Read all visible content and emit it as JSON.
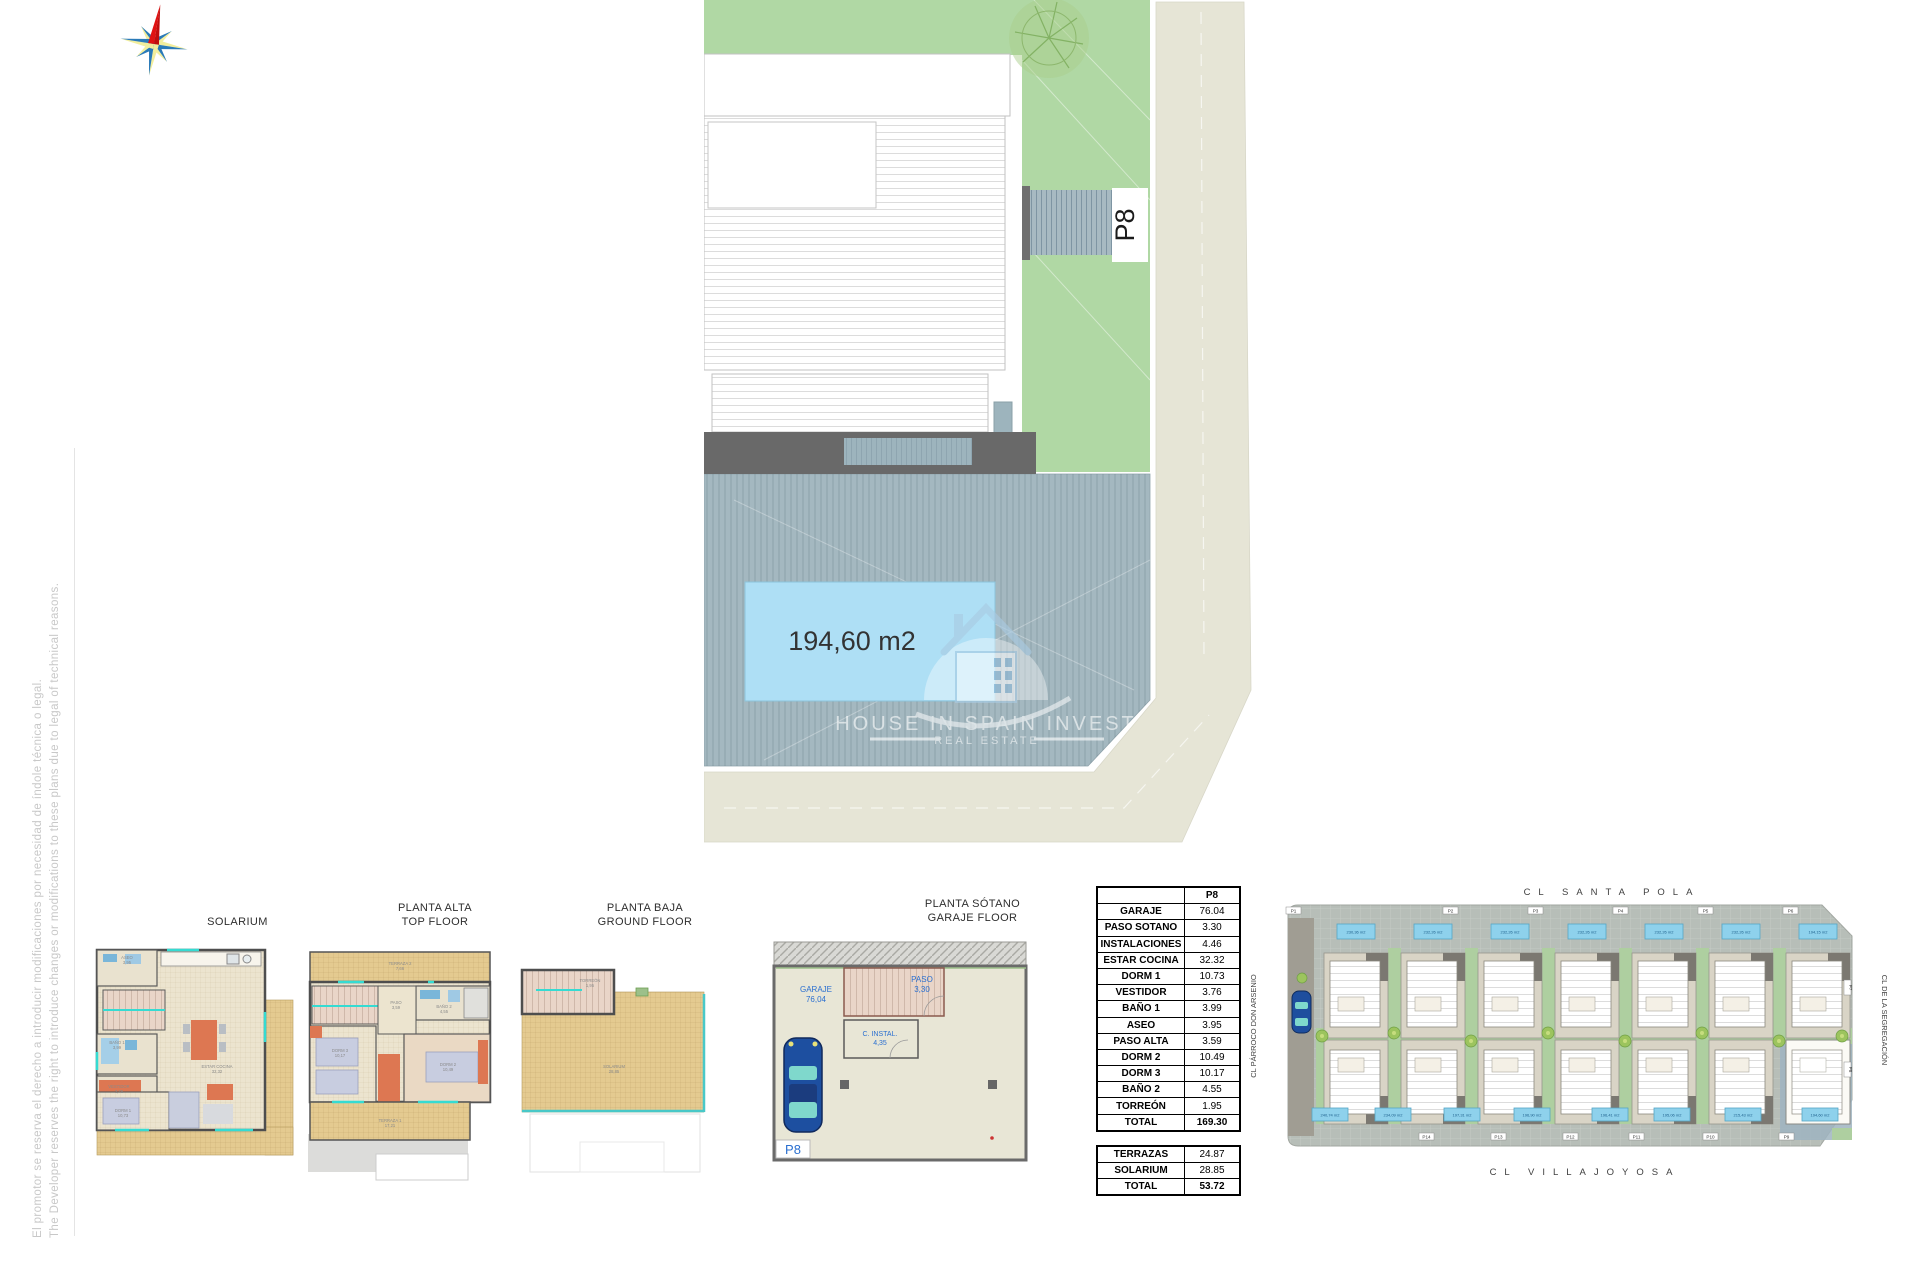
{
  "disclaimer": {
    "es": "El promotor se reserva el derecho a introducir modificaciones por necesidad de índole técnica o legal.",
    "en": "The Developer reserves the right to introduce changes or modifications to these plans due to legal of technical reasons."
  },
  "logo": {
    "name": "HOUSE IN SPAIN INVEST",
    "tagline": "REAL ESTATE"
  },
  "main_plan": {
    "plot": "P8",
    "pool_area": "194,60 m2"
  },
  "floor_plans": {
    "plan1": {
      "title": "SOLARIUM",
      "rooms": {
        "aseo": "ASEO",
        "aseo_v": "3,95",
        "bano1": "BAÑO 1",
        "bano1_v": "3,99",
        "vestidor": "VESTIDOR",
        "vestidor_v": "3,76",
        "dorm1": "DORM 1",
        "dorm1_v": "10,73",
        "estar": "ESTAR COCINA",
        "estar_v": "32,32"
      }
    },
    "plan2": {
      "title_es": "PLANTA ALTA",
      "title_en": "TOP FLOOR",
      "rooms": {
        "terraza2": "TERRAZA 2",
        "terraza2_v": "7,66",
        "bano2": "BAÑO 2",
        "bano2_v": "4,55",
        "paso": "PASO",
        "paso_v": "3,59",
        "dorm3": "DORM 3",
        "dorm3_v": "10,17",
        "dorm2": "DORM 2",
        "dorm2_v": "10,49",
        "terraza1": "TERRAZA 1",
        "terraza1_v": "17,21"
      }
    },
    "plan3": {
      "title_es": "PLANTA BAJA",
      "title_en": "GROUND FLOOR",
      "rooms": {
        "torreon": "TORREÓN",
        "torreon_v": "1,95",
        "solarium": "SOLARIUM",
        "solarium_v": "28,85"
      }
    },
    "plan4": {
      "title_es": "PLANTA SÓTANO",
      "title_en": "GARAJE FLOOR",
      "rooms": {
        "garaje": "GARAJE",
        "garaje_v": "76,04",
        "paso": "PASO",
        "paso_v": "3,30",
        "cinstal": "C. INSTAL.",
        "cinstal_v": "4,35",
        "plot": "P8"
      }
    }
  },
  "area_table": {
    "header": "P8",
    "rows": [
      {
        "label": "GARAJE",
        "value": "76.04"
      },
      {
        "label": "PASO SOTANO",
        "value": "3.30"
      },
      {
        "label": "INSTALACIONES",
        "value": "4.46"
      },
      {
        "label": "ESTAR COCINA",
        "value": "32.32"
      },
      {
        "label": "DORM 1",
        "value": "10.73"
      },
      {
        "label": "VESTIDOR",
        "value": "3.76"
      },
      {
        "label": "BAÑO 1",
        "value": "3.99"
      },
      {
        "label": "ASEO",
        "value": "3.95"
      },
      {
        "label": "PASO ALTA",
        "value": "3.59"
      },
      {
        "label": "DORM 2",
        "value": "10.49"
      },
      {
        "label": "DORM 3",
        "value": "10.17"
      },
      {
        "label": "BAÑO 2",
        "value": "4.55"
      },
      {
        "label": "TORREÓN",
        "value": "1.95"
      },
      {
        "label": "TOTAL",
        "value": "169.30"
      }
    ],
    "rows2": [
      {
        "label": "TERRAZAS",
        "value": "24.87"
      },
      {
        "label": "SOLARIUM",
        "value": "28.85"
      },
      {
        "label": "TOTAL",
        "value": "53.72"
      }
    ]
  },
  "site_plan": {
    "streets": {
      "top": "CL SANTA POLA",
      "bottom": "CL VILLAJOYOSA",
      "left": "CL PÁRROCO DON ARSENIO",
      "right": "CL DE LA SEGREGACIÓN"
    },
    "top_lots": [
      "P1",
      "P2",
      "P3",
      "P4",
      "P5",
      "P6"
    ],
    "side_lots": [
      "P7",
      "P8"
    ],
    "bottom_lots": [
      "P14",
      "P13",
      "P12",
      "P11",
      "P10",
      "P9"
    ],
    "top_areas": [
      "230,36 m2",
      "232,26 m2",
      "232,26 m2",
      "232,26 m2",
      "232,26 m2",
      "232,26 m2",
      "194,15 m2"
    ],
    "bottom_areas": [
      "240,74 m2",
      "234,09 m2",
      "197,31 m2",
      "196,90 m2",
      "196,41 m2",
      "195,06 m2",
      "215,43 m2",
      "194,60 m2"
    ]
  }
}
